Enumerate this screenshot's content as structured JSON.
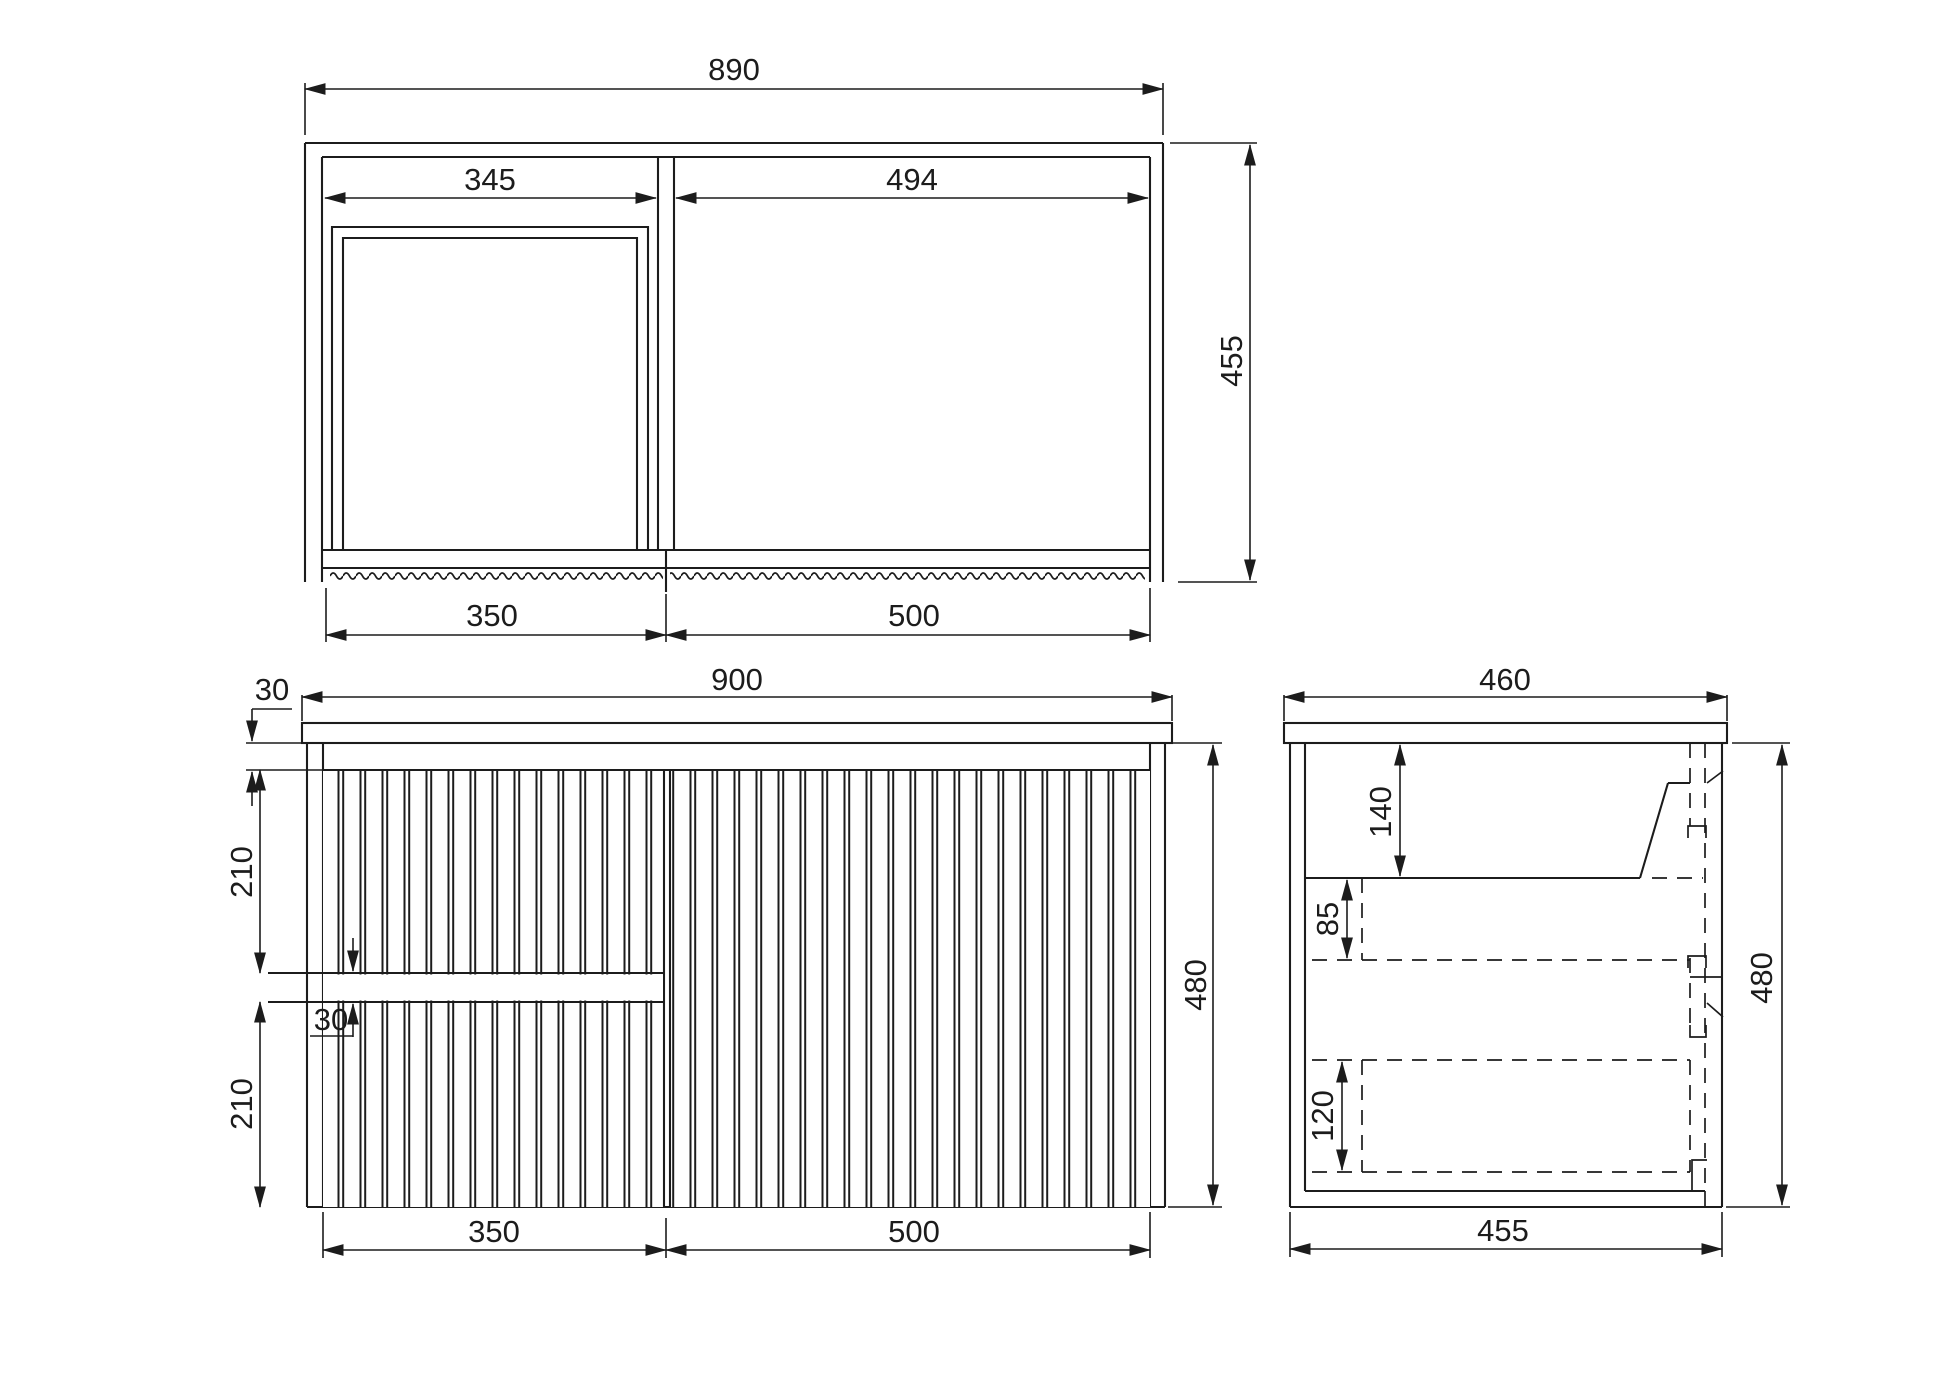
{
  "drawing": {
    "background": "#ffffff",
    "ink": "#1c1c1c",
    "views": {
      "top": {
        "title": "plan-view",
        "dims": {
          "overall_width": "890",
          "opening_left": "345",
          "opening_right": "494",
          "overall_depth": "455",
          "door_left": "350",
          "door_right": "500"
        }
      },
      "front": {
        "title": "front-elevation",
        "dims": {
          "top_rail": "30",
          "overall_width": "900",
          "drawer_upper": "210",
          "drawer_gap": "30",
          "drawer_lower": "210",
          "door_left": "350",
          "door_right": "500",
          "overall_height": "480"
        }
      },
      "side": {
        "title": "side-section",
        "dims": {
          "overall_depth": "460",
          "basin_depth": "140",
          "runner_offset": "85",
          "drawer_box": "120",
          "bottom_depth": "455",
          "overall_height": "480"
        }
      }
    }
  }
}
